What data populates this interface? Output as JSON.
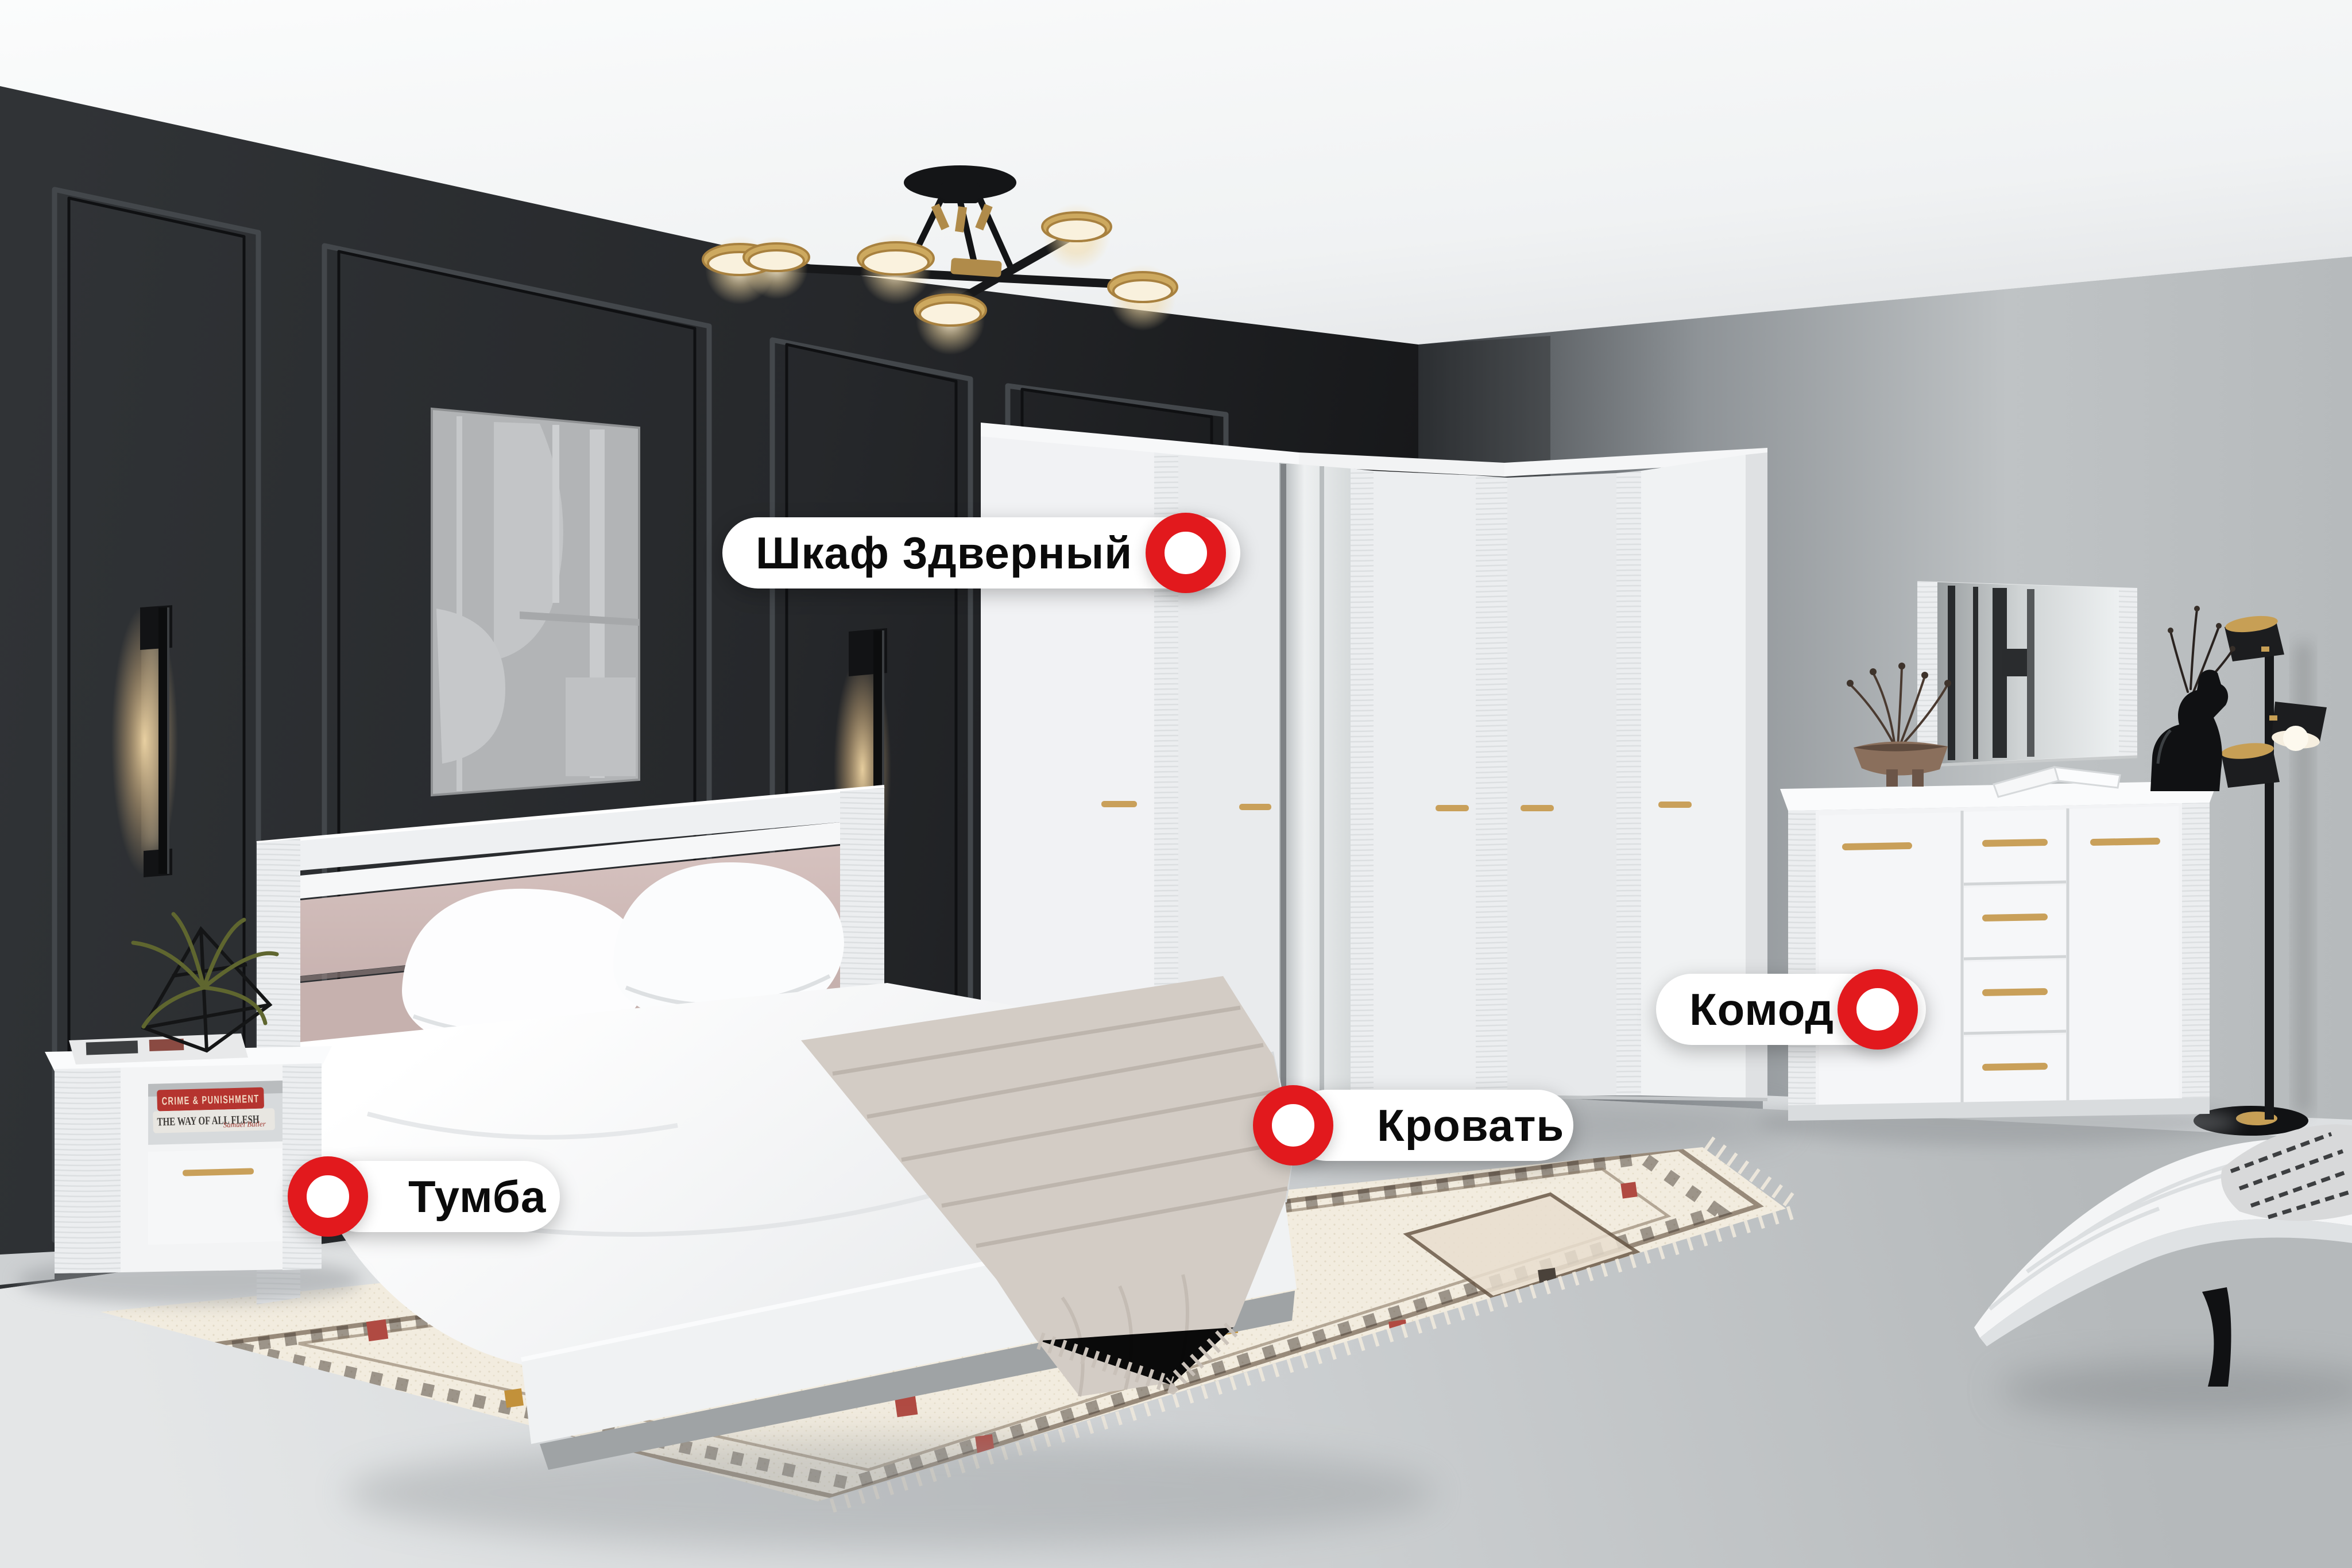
{
  "labels": {
    "wardrobe": "Шкаф 3дверный",
    "bed": "Кровать",
    "nightstand": "Тумба",
    "dresser": "Комод"
  },
  "decor_books": {
    "red_title": "CRIME & PUNISHMENT",
    "gray_title": "THE WAY OF ALL FLESH",
    "gray_author": "Samuel Butler"
  },
  "palette": {
    "marker_red": "#E2191D",
    "label_bg": "#FFFFFF",
    "label_text": "#0B0B0B",
    "dark_wall": "#2A2C2F",
    "light_wall": "#C2C6C8",
    "ceiling": "#F5F6F7",
    "floor": "#CDD1D3",
    "furniture_white": "#F2F3F5",
    "gold_handle": "#C9A05A",
    "headboard_pink": "#CBB6B3"
  }
}
